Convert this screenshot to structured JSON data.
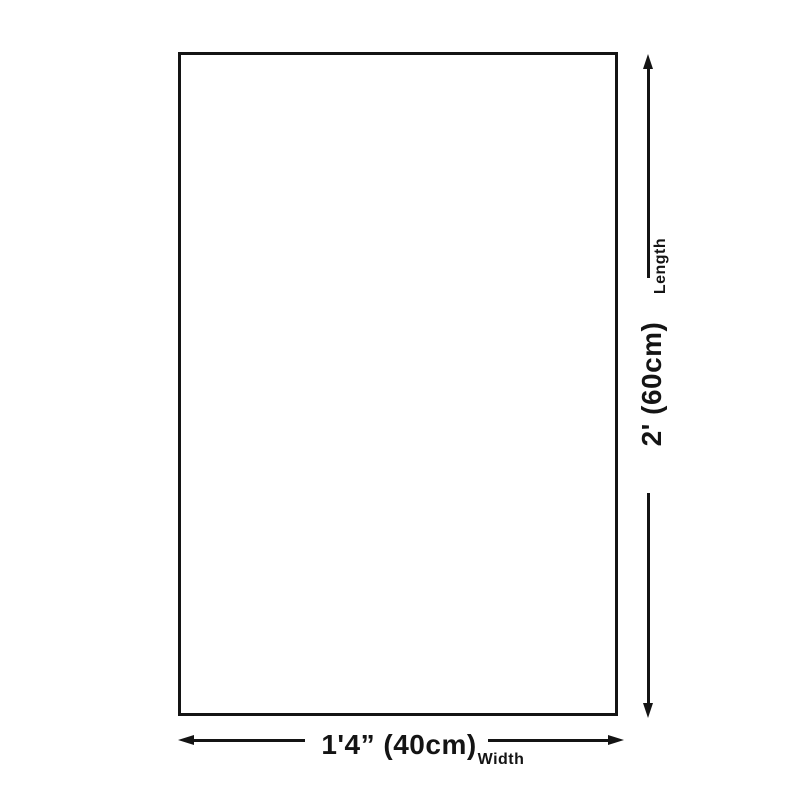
{
  "theme": {
    "ink": "#141414",
    "bg": "#ffffff"
  },
  "diagram": {
    "name": "product-dimensions-diagram",
    "shape": "rectangle",
    "length_dimension": {
      "axis_label": "Length",
      "value_label": "2' (60cm)"
    },
    "width_dimension": {
      "axis_label": "Width",
      "value_label": "1'4” (40cm)"
    }
  }
}
